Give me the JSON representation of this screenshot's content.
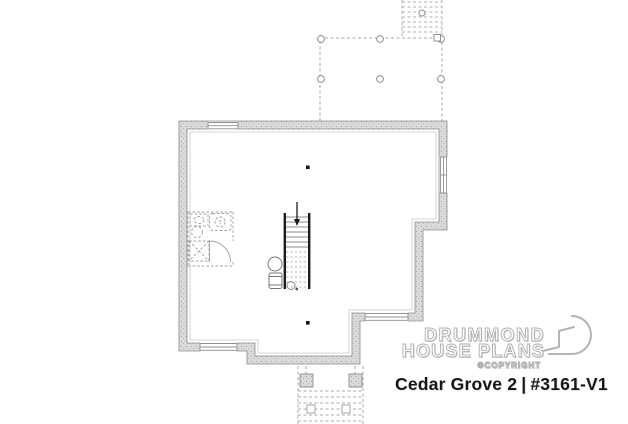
{
  "branding": {
    "logo_line1": "DRUMMOND",
    "logo_line2": "HOUSE PLANS",
    "copyright_label": "©COPYRIGHT",
    "plan_name": "Cedar Grove 2",
    "divider": "|",
    "plan_code": "#3161-V1"
  },
  "plan": {
    "level": "basement",
    "bathroom": {
      "tub_label": "T"
    },
    "colors": {
      "wall_fill": "#dcdcdc",
      "wall_speckle": "#9e9e9e",
      "wall_outline": "#8c8c8c",
      "dashed_line": "#a8a8a8",
      "stair_dark": "#1c1c1c",
      "fixture_line": "#777777",
      "title_text": "#161616",
      "ghost_outline": "#aeaeae"
    }
  }
}
